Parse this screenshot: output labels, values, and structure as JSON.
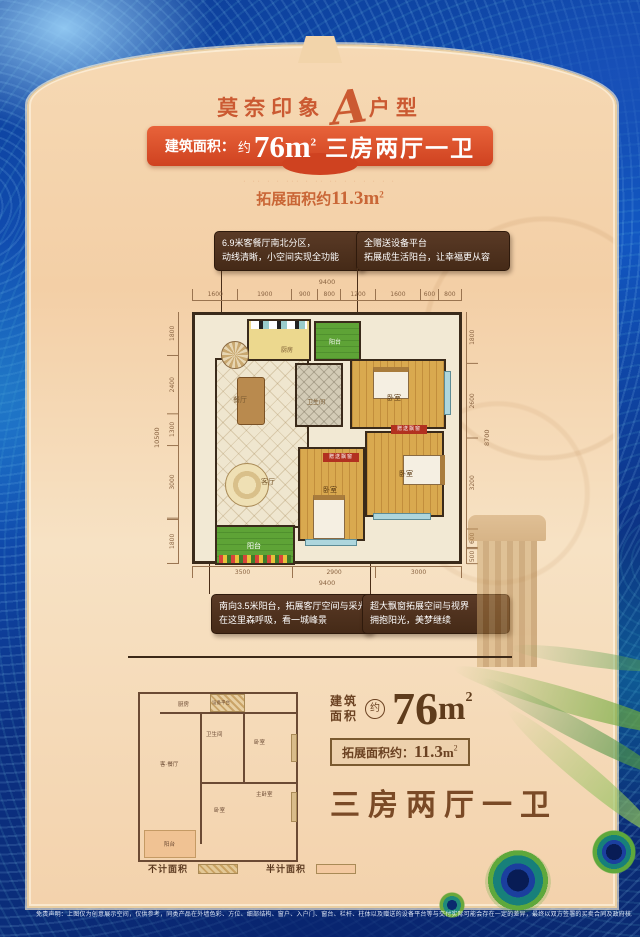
{
  "header": {
    "title": {
      "left": "莫奈印象",
      "script": "A",
      "right": "户型"
    },
    "banner": {
      "label": "建筑面积：",
      "approx": "约",
      "area": "76m",
      "area_sup": "2",
      "rooms": "三房两厅一卫"
    },
    "micro_text": "· ·· · · ··· · ·· ·· · ·  · · · ·",
    "expand": {
      "label": "拓展面积约",
      "value": "11.3",
      "unit": "m",
      "sup": "2"
    }
  },
  "callouts": {
    "top_left": {
      "line1": "6.9米客餐厅南北分区，",
      "line2": "动线清晰，小空间实现全功能"
    },
    "top_right": {
      "line1": "全赠送设备平台",
      "line2": "拓展成生活阳台，让幸福更从容"
    },
    "bottom_left": {
      "line1": "南向3.5米阳台，拓展客厅空间与采光",
      "line2": "在这里森呼吸，看一城峰景"
    },
    "bottom_right": {
      "line1": "超大飘窗拓展空间与视界",
      "line2": "拥抱阳光，美梦继续"
    }
  },
  "plan": {
    "dims_top_total": "9400",
    "dims_top": [
      "1600",
      "1900",
      "900",
      "800",
      "1200",
      "1600",
      "600",
      "800"
    ],
    "dims_left_total": "10500",
    "dims_left": [
      "1800",
      "2400",
      "1300",
      "3000",
      "1800"
    ],
    "dims_right_total": "8700",
    "dims_right": [
      "1800",
      "2600",
      "3200",
      "600",
      "500"
    ],
    "dims_bottom": [
      "3500",
      "2900",
      "3000"
    ],
    "dims_bottom_total": "9400",
    "rooms": {
      "dining": "餐厅",
      "living": "客厅",
      "kitchen": "厨房",
      "bath": "卫生间",
      "bed_top": "卧室",
      "bed_mid": "卧室",
      "bed_master": "卧室",
      "balcony_top": "阳台",
      "balcony_bottom": "阳台"
    },
    "gift_tag1": "赠送飘窗",
    "gift_tag2": "赠送飘窗"
  },
  "mini_plan": {
    "rooms": {
      "kitchen": "厨房",
      "platform": "设备平台",
      "bath": "卫生间",
      "bed_top": "卧室",
      "living": "客·餐厅",
      "master": "主卧室",
      "bed": "卧室",
      "balcony": "阳台"
    },
    "legend": {
      "not_counted": "不计面积",
      "half_counted": "半计面积"
    }
  },
  "summary": {
    "build1": "建筑",
    "build2": "面积",
    "approx": "约",
    "area": "76",
    "unit": "m",
    "unit_sup": "2",
    "expand_label": "拓展面积约：",
    "expand_value": "11.3",
    "expand_unit": "m",
    "expand_sup": "2",
    "rooms": "三房两厅一卫"
  },
  "footer": {
    "disclaimer": "免责声明：上图仅为创意展示空间，仅供参考，同类产品在外墙色彩、方位、细部结构、窗户、入户门、窗台、栏杆、柱体以及赠送的设备平台等与交付实际可能会存在一定的差异，最终以双方签署的买卖合同及政府核准文件及交付时的实际为准。"
  },
  "colors": {
    "accent_red": "#d6492a",
    "callout_brown": "#4a2d1c",
    "text_brown": "#6b4222",
    "balcony_green": "#5ea336",
    "wood": "#d9a94f",
    "panel_cream": "#f5d8b2",
    "bg_blue": "#0d3d96"
  }
}
